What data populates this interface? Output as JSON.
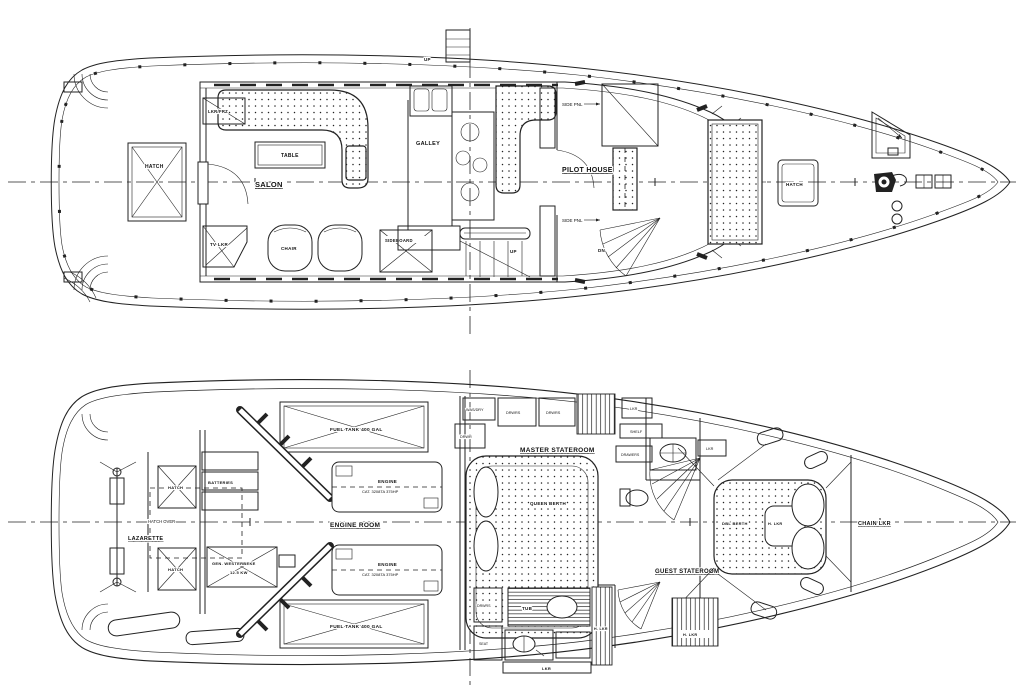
{
  "drawing": {
    "ink_color": "#222222",
    "paper_color": "#ffffff"
  },
  "main_deck": {
    "labels": {
      "up_mast": "UP",
      "aft_hatch": "HATCH",
      "tv_lkr": "TV LKR",
      "salon": "SALON",
      "table": "TABLE",
      "chair": "CHAIR",
      "sideboard": "SIDEBOARD",
      "lkr_frz": "LKR/FRZ",
      "galley": "GALLEY",
      "stair_up": "UP",
      "pilot_house": "PILOT HOUSE",
      "side_pnl_fwd": "SIDE PNL",
      "side_pnl_aft": "SIDE PNL",
      "dn": "DN",
      "fore_hatch": "HATCH"
    }
  },
  "lower_deck": {
    "labels": {
      "lazarette": "LAZARETTE",
      "hatch_over": "HATCH OVER",
      "hatch_1": "HATCH",
      "hatch_2": "HATCH",
      "batteries": "BATTERIES",
      "generator_line1": "GEN. WESTERBEKE",
      "generator_line2": "12.5 KW",
      "fuel_tank_fwd": "FUEL TANK 400 GAL",
      "fuel_tank_aft": "FUEL TANK 400 GAL",
      "engine_room": "ENGINE ROOM",
      "engine_1_line1": "ENGINE",
      "engine_1_line2": "CAT. 3208TA 375HP",
      "engine_2_line1": "ENGINE",
      "engine_2_line2": "CAT. 3208TA 375HP",
      "master_stateroom": "MASTER STATEROOM",
      "was_dry": "WAS/DRY",
      "drwrs_1": "DRWRS",
      "drwrs_2": "DRWRS",
      "drwr": "DRWR",
      "lkr_top": "LKR",
      "shelf": "SHELF",
      "queen_berth": "QUEEN BERTH",
      "drawers": "DRAWERS",
      "tub": "TUB",
      "lkr_vanity": "LKR",
      "drwrs_3": "DRWRS",
      "seat": "SEAT",
      "h_lkr_1": "H. LKR",
      "h_lkr_2": "H. LKR",
      "guest_stateroom": "GUEST STATEROOM",
      "dbl_berth": "DBL BERTH",
      "h_lkr_3": "H. LKR",
      "lkr_guest": "LKR",
      "chain_lkr": "CHAIN LKR"
    }
  }
}
